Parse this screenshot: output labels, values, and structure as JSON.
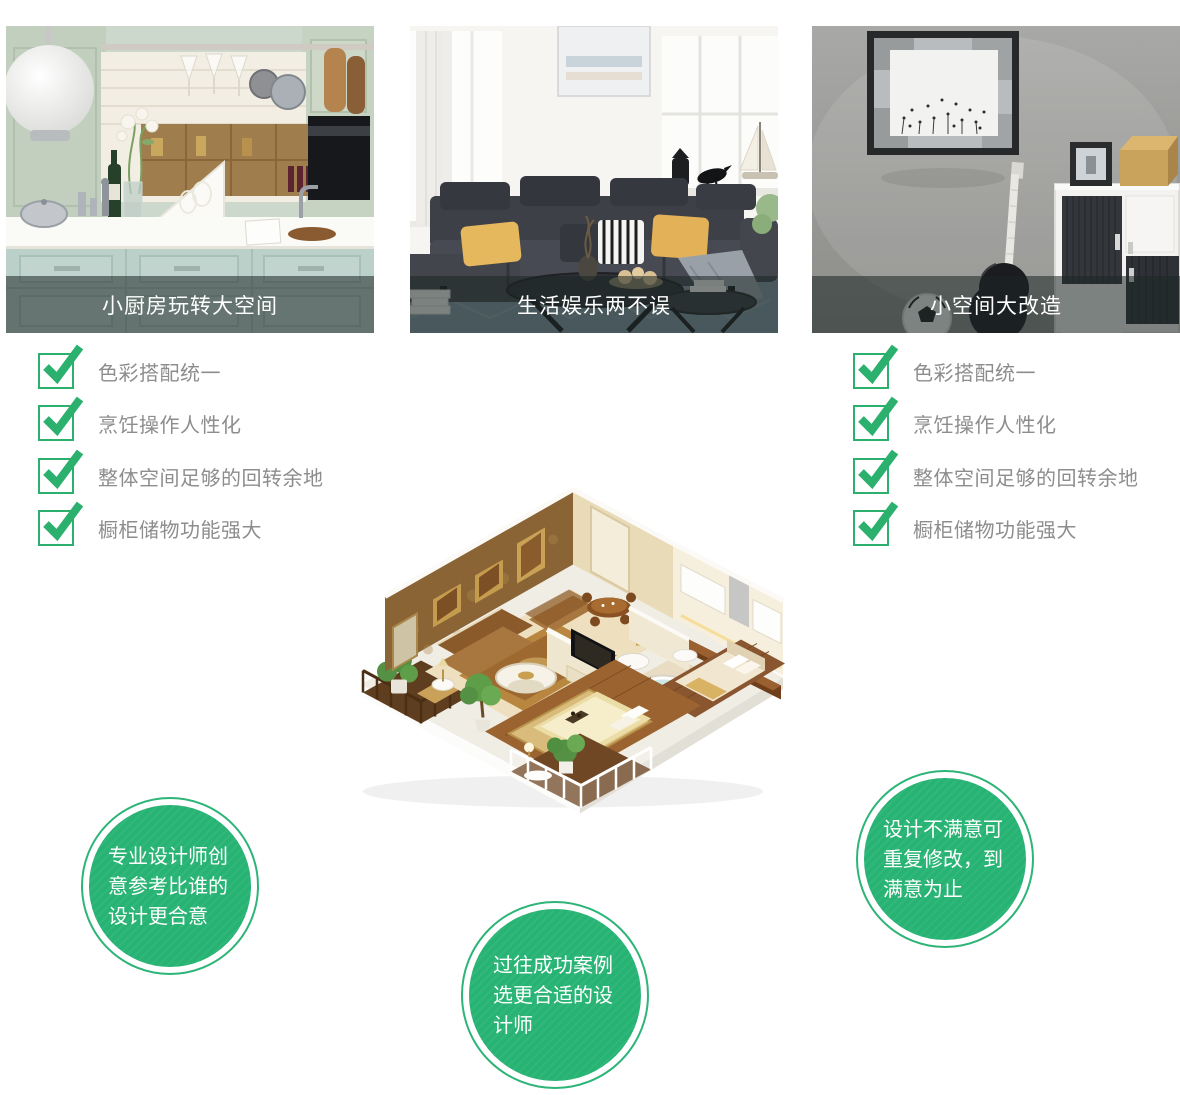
{
  "cards": [
    {
      "caption": "小厨房玩转大空间"
    },
    {
      "caption": "生活娱乐两不误"
    },
    {
      "caption": "小空间大改造"
    }
  ],
  "checklists": {
    "left": {
      "items": [
        "色彩搭配统一",
        "烹饪操作人性化",
        "整体空间足够的回转余地",
        "橱柜储物功能强大"
      ]
    },
    "right": {
      "items": [
        "色彩搭配统一",
        "烹饪操作人性化",
        "整体空间足够的回转余地",
        "橱柜储物功能强大"
      ]
    }
  },
  "bubbles": {
    "left": {
      "text": "专业设计师创意参考比谁的设计更合意"
    },
    "right": {
      "text": "设计不满意可重复修改，到满意为止"
    },
    "bottom": {
      "text": "过往成功案例选更合适的设计师"
    }
  },
  "colors": {
    "check_green": "#2cb06e",
    "badge_green": "#27b373",
    "caption_overlay": "rgba(28,38,36,0.55)",
    "caption_text": "#ffffff",
    "list_text": "#8d8d8d"
  }
}
